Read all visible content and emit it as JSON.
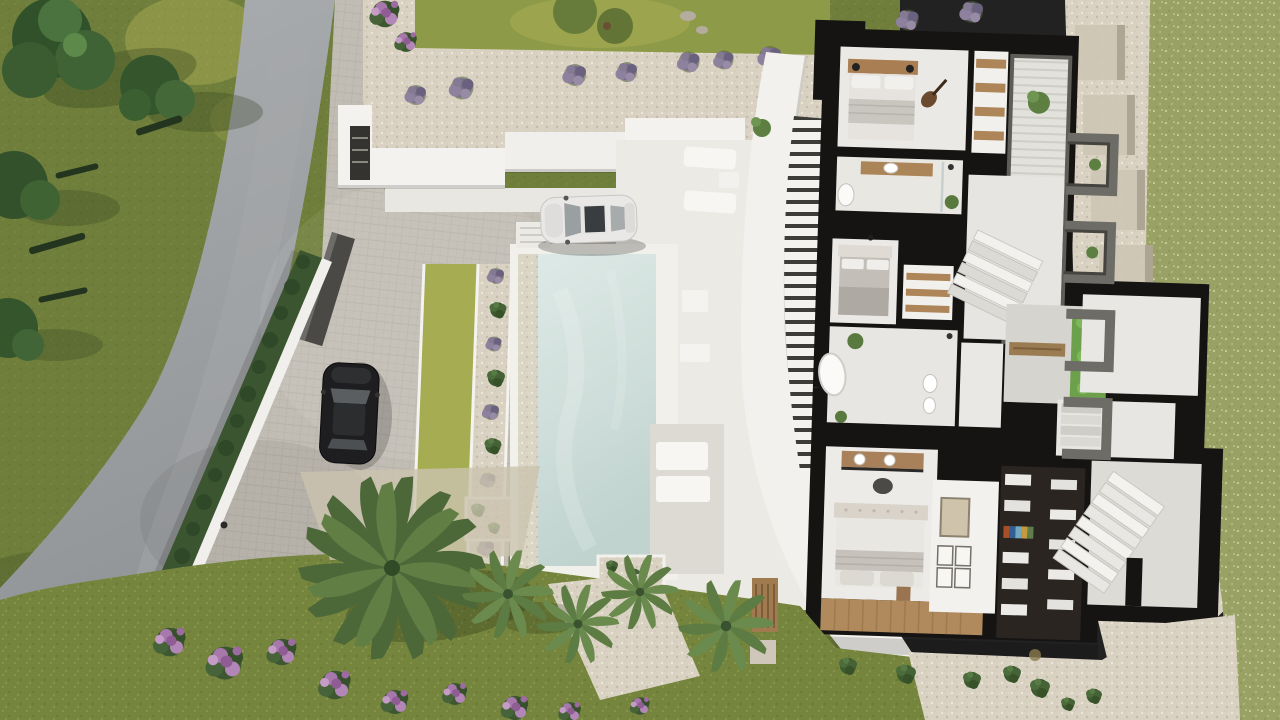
{
  "scene": {
    "type": "aerial-3d-architectural-render",
    "subject": "top-down render of a modern villa: cutaway floor plan, infinity pool, driveway, landscaped garden",
    "objects": [
      "asphalt-road",
      "cypress-hedge",
      "perimeter-white-wall",
      "entrance-gate",
      "paver-driveway",
      "white-car",
      "black-car",
      "lavender-bushes",
      "gravel-path",
      "stepped-retaining-walls",
      "sun-loungers",
      "swimming-pool",
      "pool-deck",
      "sunken-lounge-terrace",
      "curved-white-roof",
      "villa-cutaway-floorplan",
      "bedroom-1",
      "bedroom-2",
      "master-bedroom",
      "bathroom",
      "master-bathroom",
      "walk-in-closet",
      "picture-wall",
      "staircase",
      "vertical-garden",
      "courtyard",
      "big-palm-tree",
      "fan-palms",
      "flowering-purple-shrubs",
      "lawn",
      "bench",
      "planter-boxes",
      "boundary-gravel",
      "sage-lawn"
    ]
  },
  "colors": {
    "grass_left_base": "#6f7e3b",
    "grass_right_base": "#9aa165",
    "garden_grass_base": "#75853d",
    "road_top": "#abaeb0",
    "road_bottom": "#8f9295",
    "paver_base": "#c2bdb4",
    "gravel_base": "#d9d2c2",
    "hedge_green": "#3a5530",
    "lawn_strip": "#a6ac52",
    "pool_water_top": "#dde9e6",
    "pool_water_bottom": "#c0d3cf",
    "pool_coping": "#f1f0ea",
    "deck_white": "#eceae5",
    "roof_white": "#f2f1ee",
    "sunken_terrace": "#dcdad3",
    "cut_wall_black": "#151413",
    "room_floor": "#ebe9e5",
    "wood": "#ab8458",
    "wood_floor": "#b08a5c",
    "closet_dark": "#2b2522",
    "frame_gray": "#6e6c67",
    "lavender": "#8d819d",
    "flower_purple": "#b286b6",
    "palm_green": "#617f45",
    "white_wall": "#f3f2ee",
    "car_white": "#e9e8e6",
    "car_black": "#1e1e20"
  }
}
